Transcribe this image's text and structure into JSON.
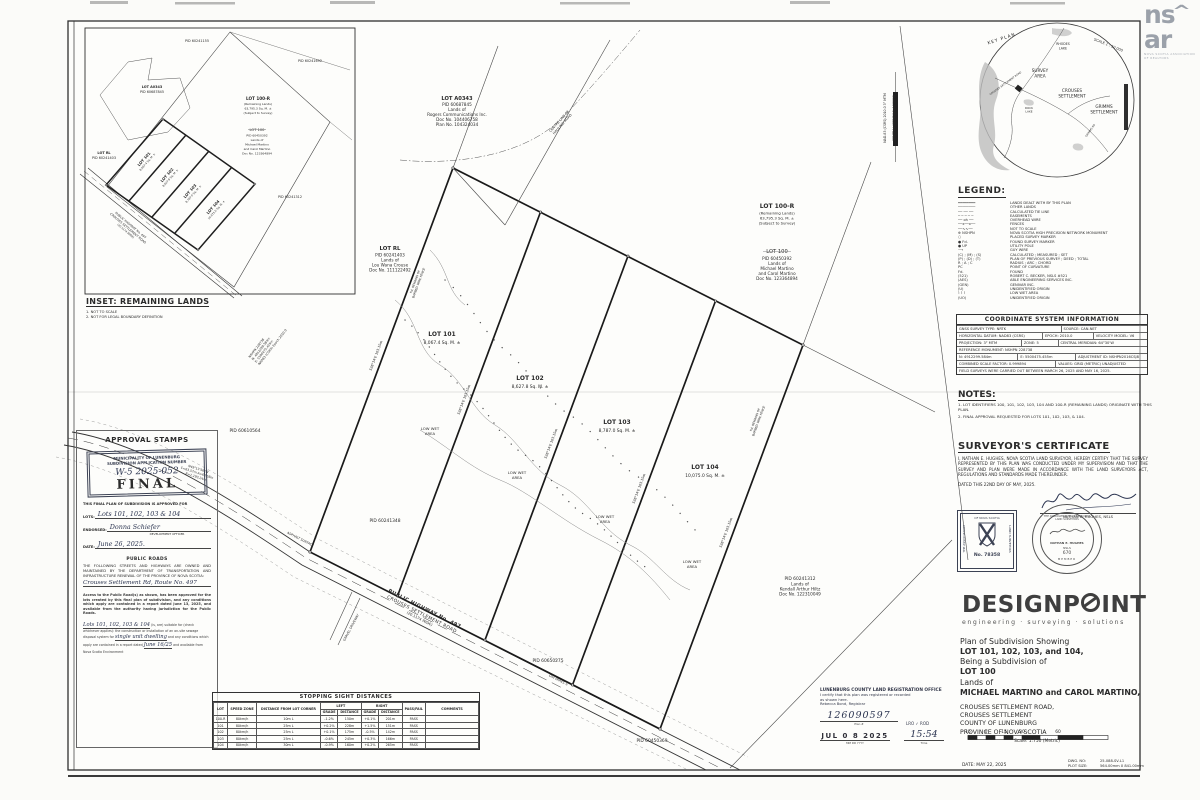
{
  "nsar": {
    "n1": "ns",
    "roof": "^",
    "n2": "ar",
    "tag1": "NOVA SCOTIA ASSOCIATION",
    "tag2": "OF REALTORS"
  },
  "keyplan": {
    "title": "KEY PLAN",
    "scale": "SCALE 1 : 50 000",
    "rhodes1": "RHODES",
    "rhodes2": "LAKE",
    "survey1": "SURVEY",
    "survey2": "AREA",
    "crouses1": "CROUSES",
    "crouses2": "SETTLEMENT",
    "grimms1": "GRIMMS",
    "grimms2": "SETTLEMENT",
    "rock1": "ROCK",
    "rock2": "LAKE",
    "csr": "CROUSES SETTLEMENT ROAD",
    "grd": "GRIMMS RD"
  },
  "legend": {
    "title": "LEGEND:",
    "items": [
      {
        "sym": "━━━━━━━━",
        "label": "LANDS DEALT WITH BY THIS PLAN"
      },
      {
        "sym": "────────",
        "label": "OTHER LANDS"
      },
      {
        "sym": "── ── ──",
        "label": "CALCULATED TIE LINE"
      },
      {
        "sym": "─ ─ ─ ─ ─",
        "label": "EASEMENTS"
      },
      {
        "sym": "── oh ──",
        "label": "OVERHEAD WIRE"
      },
      {
        "sym": "──x──x──",
        "label": "FENCES"
      },
      {
        "sym": "──∿∿──",
        "label": "NOT TO SCALE"
      },
      {
        "sym": "⊕ NSHPN",
        "label": "NOVA SCOTIA HIGH PRECISION NETWORK MONUMENT"
      },
      {
        "sym": "○",
        "label": "PLACED SURVEY MARKER"
      },
      {
        "sym": "● Fd.",
        "label": "FOUND SURVEY MARKER"
      },
      {
        "sym": "● UP",
        "label": "UTILITY POLE"
      },
      {
        "sym": "⟶",
        "label": "GUY WIRE"
      },
      {
        "sym": "(C) ; (M) ; (S)",
        "label": "CALCULATED ; MEASURED ; SET"
      },
      {
        "sym": "(P) ; (D) ; (T)",
        "label": "PLAN OF PREVIOUS SURVEY ; DEED ; TOTAL"
      },
      {
        "sym": "R ; A ; C",
        "label": "RADIUS ; ARC ; CHORD"
      },
      {
        "sym": "PC",
        "label": "POINT OF CURVATURE"
      },
      {
        "sym": "Fd.",
        "label": "FOUND"
      },
      {
        "sym": "(521)",
        "label": "ROBERT C. BECKER, NSLS #521"
      },
      {
        "sym": "(AES)",
        "label": "ABLE ENGINEERING SERVICES INC."
      },
      {
        "sym": "(GEN)",
        "label": "GENIVAR INC."
      },
      {
        "sym": "(U)",
        "label": "UNIDENTIFIED ORIGIN"
      },
      {
        "sym": "⌇ ⌇ ⌇",
        "label": "LOW WET AREA"
      },
      {
        "sym": "(UO)",
        "label": "UNIDENTIFIED ORIGIN"
      }
    ]
  },
  "csi": {
    "title": "COORDINATE SYSTEM INFORMATION",
    "r1c1": "GNSS SURVEY TYPE:  NRTK",
    "r1c2": "SOURCE:  CAN-NET",
    "r2c1": "HORIZONTAL DATUM:  NAD83 (CSRS)",
    "r2c2": "EPOCH:  2010.0",
    "r2c3": "VELOCITY MODEL:  V6",
    "r3c1": "PROJECTION:  3° MTM",
    "r3c2": "ZONE:  5",
    "r3c3": "CENTRAL MERIDIAN:  64°30'W",
    "r4c1": "REFERENCE MONUMENT:  NSHPN 228738",
    "r5c1": "N: 4912299.584m",
    "r5c2": "E: 5500475.455m",
    "r5c3": "ADJUSTMENT ID: NSHPN2016CSJ8",
    "r6c1": "COMBINED SCALE FACTOR:  0.999894",
    "r6c2": "VALUES:  GRID (METRIC) UNADJUSTED",
    "r7c1": "FIELD SURVEYS WERE CARRIED OUT BETWEEN MARCH 26, 2025 AND MAY 16, 2025."
  },
  "notes": {
    "title": "NOTES:",
    "n1": "1. LOT IDENTIFIERS 100, 101, 102, 103, 104 AND 100-R (REMAINING LANDS) ORIGINATE WITH THIS PLAN.",
    "n2": "2. FINAL APPROVAL REQUESTED FOR LOTS 101, 102, 103, & 104."
  },
  "cert": {
    "title": "SURVEYOR'S CERTIFICATE",
    "body": "I, NATHAN E. HUGHES, NOVA SCOTIA LAND SURVEYOR, HEREBY CERTIFY THAT THE SURVEY REPRESENTED BY THIS PLAN WAS CONDUCTED UNDER MY SUPERVISION AND THAT THE SURVEY AND PLAN WERE MADE IN ACCORDANCE WITH THE LAND SURVEYORS ACT, REGULATIONS AND STANDARDS MADE THEREUNDER.",
    "dated": "DATED THIS 22ND DAY OF MAY, 2025.",
    "sig_name": "NATHAN E. HUGHES, NSLS"
  },
  "stamp_sq": {
    "t": "OF NOVA SCOTIA",
    "left": "THE ASSOCIATION",
    "right": "LAND SURVEYORS",
    "no": "No.  78358"
  },
  "seal": {
    "arc": "THE ASSOCIATION OF NOVA SCOTIA",
    "arc2": "LAND SURVEYORS",
    "nm": "NATHAN E. HUGHES",
    "nsls": "NSLS",
    "num": "670",
    "mb": "MEMBER"
  },
  "dp": {
    "logo1": "DESIGNP",
    "logo2": "INT",
    "tag": "engineering · surveying · solutions",
    "t1": "Plan of Subdivision Showing",
    "t2": "LOT 101, 102, 103, and 104,",
    "t3": "Being a Subdivision of",
    "t4": "LOT 100",
    "t5": "Lands of",
    "t6": "MICHAEL MARTINO and CAROL MARTINO,",
    "a1": "CROUSES SETTLEMENT ROAD,",
    "a2": "CROUSES SETTLEMENT",
    "a3": "COUNTY OF LUNENBURG",
    "a4": "PROVINCE OF NOVA SCOTIA"
  },
  "reg": {
    "l1": "LUNENBURG COUNTY LAND REGISTRATION OFFICE",
    "l2": "I certify that this plan was registered or recorded",
    "l3": "as shown here.",
    "l4": "Rebecca Bond, Registrar",
    "plan_no": "126090597",
    "plan_lbl": "Plan #",
    "lro": "LRO ✓  ROD",
    "date": "JUL 0 8 2025",
    "date_lbl": "MM   DD   YYYY",
    "time": "15:54",
    "time_lbl": "Time"
  },
  "scalebar": {
    "n1": "15",
    "n2": "0",
    "n3": "15",
    "n4": "30",
    "n5": "60",
    "caption": "Scale: 1:750 (Metric)"
  },
  "footer": {
    "date": "DATE:  MAY 22, 2025",
    "dwg_lbl": "DWG. NO:",
    "dwg": "25-088-SV-L1",
    "plot_lbl": "PLOT SIZE:",
    "plot": "564.00mm X 841.00mm"
  },
  "approval": {
    "title": "APPROVAL STAMPS",
    "stamp1": "MUNICIPALITY OF LUNENBURG",
    "stamp2": "SUBDIVISION APPLICATION NUMBER",
    "app_no": "W-5 2025-052",
    "final": "FINAL",
    "approved_for": "THIS FINAL PLAN OF SUBDIVISION IS APPROVED FOR",
    "lots_lbl": "LOTS:",
    "lots_val": "Lots 101, 102, 103 & 104",
    "endorsed_lbl": "ENDORSED:",
    "endorsed_val": "Donna Schiefer",
    "endorsed_sub": "DEVELOPMENT OFFICER",
    "date_lbl": "DATE:",
    "date_val": "June 26, 2025.",
    "roads_title": "PUBLIC ROADS",
    "roads_body": "THE FOLLOWING STREETS AND HIGHWAYS ARE OWNED AND MAINTAINED BY THE DEPARTMENT OF TRANSPORTATION AND INFRASTRUCTURE RENEWAL OF THE PROVINCE OF NOVA SCOTIA:",
    "roads_val": "Crouses Settlement Rd, Route No. 497",
    "access_body": "Access to the Public Road(s) as shown, has been approved for the lots created by this final plan of subdivision, and any conditions which apply are contained in a report dated June 13, 2025, and available from the authority having jurisdiction for the Public Roads.",
    "sw1": "Lots 101, 102, 103 & 104",
    "sw2": "(is, are) suitable for (check whichever applies):",
    "sw3": "the construction or installation of an on-site sewage disposal system for",
    "sw_val": "single unit dwelling",
    "sw4": "and any conditions which apply are contained in a report dated",
    "sw_date": "June 16/25",
    "sw5": "and available from Nova Scotia Environment"
  },
  "ssd": {
    "title": "STOPPING SIGHT DISTANCES",
    "h": {
      "lot": "LOT",
      "zone": "SPEED ZONE",
      "dist": "DISTANCE FROM LOT CORNER",
      "left": "LEFT",
      "right": "RIGHT",
      "grade": "GRADE",
      "distance": "DISTANCE",
      "pf": "PASS/FAIL",
      "comments": "COMMENTS"
    },
    "rows": [
      {
        "lot": "100-R",
        "zone": "80km/h",
        "dist": "10m L",
        "lg": "-1.2%",
        "ld": "150m",
        "rg": "+0.1%",
        "rd": "201m",
        "pf": "PASS",
        "c": ""
      },
      {
        "lot": "101",
        "zone": "80km/h",
        "dist": "25m L",
        "lg": "+0.2%",
        "ld": "228m",
        "rg": "+1.5%",
        "rd": "151m",
        "pf": "PASS",
        "c": ""
      },
      {
        "lot": "102",
        "zone": "80km/h",
        "dist": "25m L",
        "lg": "+0.1%",
        "ld": "175m",
        "rg": "-0.5%",
        "rd": "142m",
        "pf": "PASS",
        "c": ""
      },
      {
        "lot": "103",
        "zone": "80km/h",
        "dist": "25m L",
        "lg": "-0.6%",
        "ld": "245m",
        "rg": "+0.3%",
        "rd": "166m",
        "pf": "PASS",
        "c": ""
      },
      {
        "lot": "104",
        "zone": "80km/h",
        "dist": "30m L",
        "lg": "-0.9%",
        "ld": "160m",
        "rg": "+0.2%",
        "rd": "265m",
        "pf": "PASS",
        "c": ""
      }
    ]
  },
  "inset": {
    "caption": "INSET: REMAINING LANDS",
    "note1": "1. NOT TO SCALE",
    "note2": "2. NOT FOR LEGAL BOUNDARY DEFINITION",
    "pid155": "PID 60241155",
    "pid1692": "PID 60241692",
    "pid1312": "PID 60241312"
  },
  "m": {
    "lot101_name": "LOT 101",
    "lot101_area": "8,067.4 Sq. M. ±",
    "lot102_name": "LOT 102",
    "lot102_area": "8,627.8 Sq. M. ±",
    "lot103_name": "LOT 103",
    "lot103_area": "8,787.0 Sq. M. ±",
    "lot104_name": "LOT 104",
    "lot104_area": "10,075.0 Sq. M. ±",
    "low_wet_1": "LOW  WET",
    "low_wet_2": "AREA",
    "lot100r_1": "LOT 100-R",
    "lot100r_2": "(Remaining Lands)",
    "lot100r_3": "63,795.3 Sq. M. ±",
    "lot100r_4": "(Subject to Survey)",
    "lot100_1": "LOT 100",
    "lot100_2": "PID 60450392",
    "lot100_3": "Lands of",
    "lot100_4": "Michael Martino",
    "lot100_5": "and Carol Martino",
    "lot100_6": "Doc No. 123364894",
    "lotrl_1": "LOT RL",
    "lotrl_2": "PID 60241403",
    "lotrl_3": "Lands of",
    "lotrl_4": "Lou Wana Crouse",
    "lotrl_5": "Doc No. 111122492",
    "a0343_1": "LOT A0343",
    "a0343_2": "PID 60687845",
    "a0343_3": "Lands of",
    "a0343_4": "Rogers Communications Inc.",
    "a0343_5": "Doc No. 104406758",
    "a0343_6": "Plan No. 104324034",
    "kendall_1": "PID 60241312",
    "kendall_2": "Lands of",
    "kendall_3": "Kendall Arthur Hiltz",
    "kendall_4": "Doc No. 122310049",
    "pid_a": "PID 60610564",
    "pid_b": "PID 60241348",
    "pid_c": "PID 60650275",
    "pid_d": "PID 60450369",
    "road_1": "PUBLIC HIGHWAY No. 497",
    "road_2": "CROUSES SETTLEMENT ROAD",
    "road_3": "(20.1174 WIDE)",
    "hauling_1": "CENTRE LINE OF",
    "hauling_2": "HAULING ROAD",
    "grid_1": "NAD-83 (CSRS) 2010.0  3° MTM",
    "grid_2": "CENTRAL MERIDIAN 64°30'W",
    "nshpn_1": "NSHPN 228738",
    "nshpn_2": "N: 4912299.584m",
    "nshpn_3": "E: 5500475.455m",
    "nshpn_4": "NAD83 (CSRS) Epoch 2010.0",
    "curve_1": "N49°13'56\"W",
    "curve_2": "C=63.57m  A=63.58m",
    "curve_3": "R=1,193.24m",
    "bearing": "S38°14'E  103.15m",
    "fence_1": "Fd. REMAINS OF",
    "fence_2": "BARBED WIRE FENCE",
    "asphalt": "ASPHALT SURFACE",
    "ohwires": "O/H WIRES ±",
    "driveway": "GRAVEL DRIVEWAY"
  }
}
